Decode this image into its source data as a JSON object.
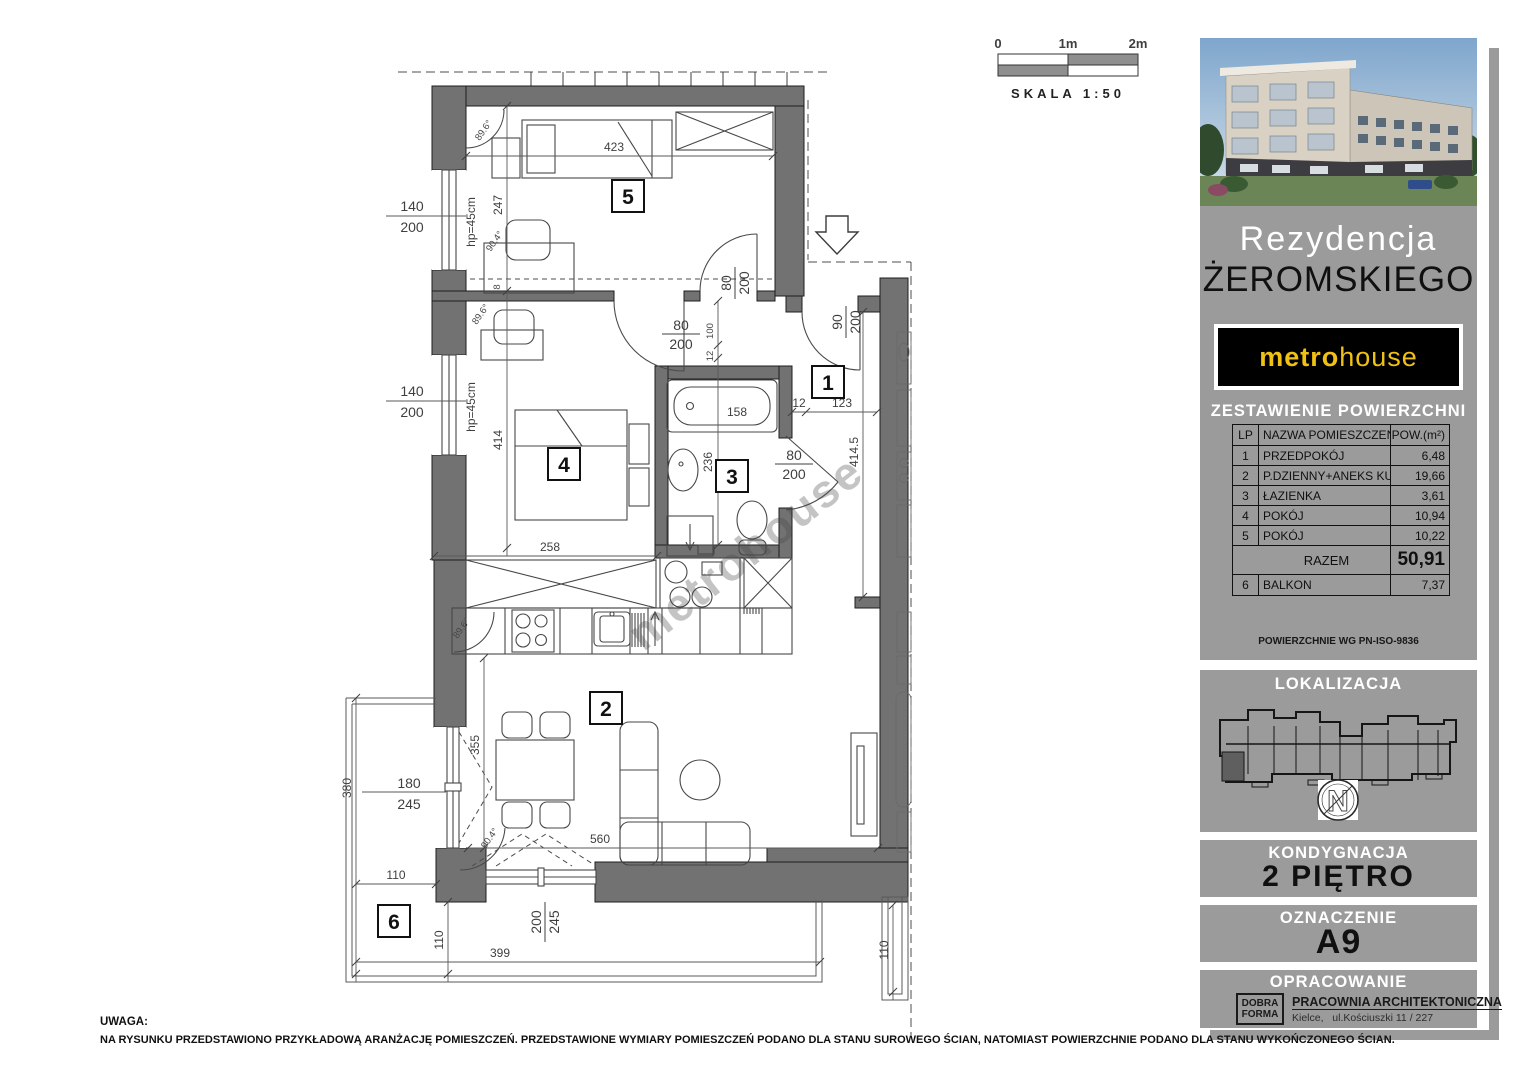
{
  "scale_bar": {
    "zero": "0",
    "one": "1m",
    "two": "2m",
    "caption": "SKALA 1:50"
  },
  "note": {
    "title": "UWAGA:",
    "body": "NA RYSUNKU PRZEDSTAWIONO PRZYKŁADOWĄ ARANŻACJĘ POMIESZCZEŃ. PRZEDSTAWIONE WYMIARY POMIESZCZEŃ PODANO DLA STANU SUROWEGO ŚCIAN, NATOMIAST POWIERZCHNIE PODANO DLA STANU WYKOŃCZONEGO ŚCIAN."
  },
  "plan": {
    "watermark": "metrohouse",
    "room_labels": {
      "r1": "1",
      "r2": "2",
      "r3": "3",
      "r4": "4",
      "r5": "5",
      "r6": "6"
    },
    "dims": {
      "d423": "423",
      "d247": "247",
      "d414": "414",
      "d258": "258",
      "d158": "158",
      "d236": "236",
      "d355": "355",
      "d560": "560",
      "d399": "399",
      "d380": "380",
      "d110a": "110",
      "d110b": "110",
      "d110c": "110",
      "d4145": "414.5",
      "d12a": "12",
      "d123": "123",
      "d100": "100",
      "d12b": "12",
      "d8": "8",
      "hp1": "hp=45cm",
      "hp2": "hp=45cm"
    },
    "fractions": {
      "win1": {
        "n": "140",
        "d": "200"
      },
      "win2": {
        "n": "140",
        "d": "200"
      },
      "door4": {
        "n": "80",
        "d": "200"
      },
      "door3": {
        "n": "80",
        "d": "200"
      },
      "door5": {
        "n": "80",
        "d": "200"
      },
      "entry": {
        "n": "90",
        "d": "200"
      },
      "balc_door": {
        "n": "180",
        "d": "245"
      },
      "slide": {
        "n": "200",
        "d": "245"
      }
    },
    "angles": {
      "a1": "89.6°",
      "a2": "90.4°",
      "a3": "89.6°",
      "a4": "89.6°",
      "a5": "90.4°"
    }
  },
  "sidebar": {
    "title1": "Rezydencja",
    "title2": "ŻEROMSKIEGO",
    "logo": {
      "metro": "metro",
      "house": "house"
    },
    "table": {
      "header": "ZESTAWIENIE POWIERZCHNI",
      "col_lp": "LP",
      "col_name": "NAZWA POMIESZCZENIA",
      "col_area": "POW.(m²)",
      "rows": [
        {
          "lp": "1",
          "name": "PRZEDPOKÓJ",
          "area": "6,48"
        },
        {
          "lp": "2",
          "name": "P.DZIENNY+ANEKS KUCH.",
          "area": "19,66"
        },
        {
          "lp": "3",
          "name": "ŁAZIENKA",
          "area": "3,61"
        },
        {
          "lp": "4",
          "name": "POKÓJ",
          "area": "10,94"
        },
        {
          "lp": "5",
          "name": "POKÓJ",
          "area": "10,22"
        }
      ],
      "total_label": "RAZEM",
      "total_value": "50,91",
      "balkon": {
        "lp": "6",
        "name": "BALKON",
        "area": "7,37"
      },
      "iso": "POWIERZCHNIE WG PN-ISO-9836"
    },
    "lokalizacja_label": "LOKALIZACJA",
    "compass_n": "N",
    "kondygnacja_label": "KONDYGNACJA",
    "kondygnacja_value": "2 PIĘTRO",
    "oznaczenie_label": "OZNACZENIE",
    "oznaczenie_value": "A9",
    "opracowanie_label": "OPRACOWANIE",
    "company": {
      "logo1": "DOBRA",
      "logo2": "FORMA",
      "name": "PRACOWNIA ARCHITEKTONICZNA",
      "address": "Kielce,   ul.Kościuszki 11 / 227"
    }
  },
  "colors": {
    "wall": "#727272",
    "sidebar_gray": "#9b9b9b",
    "brand_yellow": "#f0c115"
  }
}
